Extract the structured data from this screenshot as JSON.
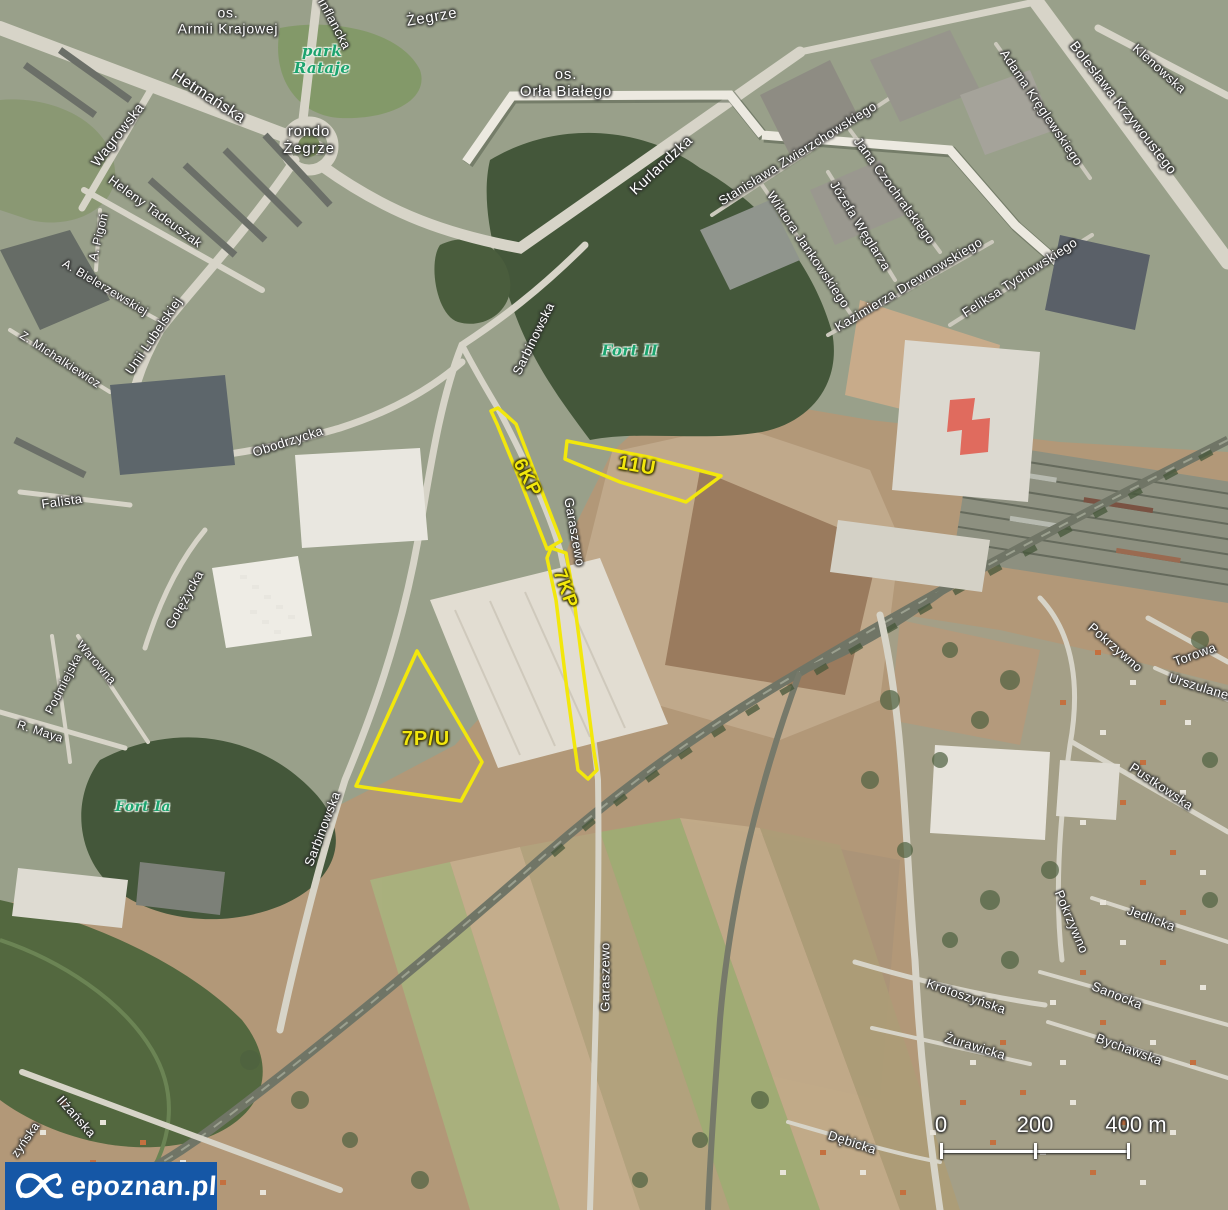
{
  "map": {
    "colors": {
      "zone_outline": "#f2e70c",
      "label_green": "#1ca36e",
      "watermark_bg": "#1557a6"
    },
    "labels": [
      {
        "t": "os.\nArmii Krajowej",
        "x": 228,
        "y": 21,
        "r": 0,
        "s": 14,
        "c": "district"
      },
      {
        "t": "Żegrze",
        "x": 432,
        "y": 18,
        "r": -10,
        "s": 15,
        "c": "district"
      },
      {
        "t": "os.\nOrła Białego",
        "x": 566,
        "y": 84,
        "r": 0,
        "s": 15,
        "c": "district"
      },
      {
        "t": "rondo\nŻegrze",
        "x": 309,
        "y": 141,
        "r": 0,
        "s": 15,
        "c": "district"
      },
      {
        "t": "park\nRataje",
        "x": 322,
        "y": 60,
        "r": 0,
        "s": 15,
        "c": "green"
      },
      {
        "t": "Fort II",
        "x": 630,
        "y": 351,
        "r": 0,
        "s": 15,
        "c": "green"
      },
      {
        "t": "Fort Ia",
        "x": 143,
        "y": 808,
        "r": 0,
        "s": 14,
        "c": "green"
      },
      {
        "t": "Hetmańska",
        "x": 208,
        "y": 97,
        "r": 33,
        "s": 16
      },
      {
        "t": "Wagrowska",
        "x": 118,
        "y": 135,
        "r": -52,
        "s": 14
      },
      {
        "t": "Inflancka",
        "x": 334,
        "y": 24,
        "r": 62,
        "s": 13
      },
      {
        "t": "Kurlandzka",
        "x": 662,
        "y": 166,
        "r": -43,
        "s": 15
      },
      {
        "t": "Heleny Tadeuszak",
        "x": 155,
        "y": 212,
        "r": 36,
        "s": 13
      },
      {
        "t": "A. Pigoń",
        "x": 99,
        "y": 237,
        "r": -76,
        "s": 12
      },
      {
        "t": "A. Bielerzewskiej",
        "x": 105,
        "y": 288,
        "r": 31,
        "s": 12
      },
      {
        "t": "Z. Michalkiewicz",
        "x": 60,
        "y": 360,
        "r": 33,
        "s": 12
      },
      {
        "t": "Unii Lubelskiej",
        "x": 154,
        "y": 336,
        "r": -56,
        "s": 13
      },
      {
        "t": "Obodrzycka",
        "x": 288,
        "y": 442,
        "r": -18,
        "s": 13
      },
      {
        "t": "Falista",
        "x": 62,
        "y": 502,
        "r": -8,
        "s": 13
      },
      {
        "t": "Gołężycka",
        "x": 185,
        "y": 600,
        "r": -61,
        "s": 13
      },
      {
        "t": "Warowna",
        "x": 96,
        "y": 663,
        "r": 49,
        "s": 12
      },
      {
        "t": "Podmiejska",
        "x": 64,
        "y": 684,
        "r": -63,
        "s": 12
      },
      {
        "t": "R. Maya",
        "x": 40,
        "y": 732,
        "r": 18,
        "s": 12
      },
      {
        "t": "Sarbinowska",
        "x": 534,
        "y": 339,
        "r": -64,
        "s": 13
      },
      {
        "t": "Sarbinowska",
        "x": 323,
        "y": 829,
        "r": -69,
        "s": 13
      },
      {
        "t": "Garaszewo",
        "x": 574,
        "y": 532,
        "r": 80,
        "s": 13
      },
      {
        "t": "Garaszewo",
        "x": 606,
        "y": 977,
        "r": -90,
        "s": 13
      },
      {
        "t": "Stanisława Zwierzchowskiego",
        "x": 798,
        "y": 154,
        "r": -32,
        "s": 13
      },
      {
        "t": "Wiktora Jankowskiego",
        "x": 808,
        "y": 250,
        "r": 56,
        "s": 13
      },
      {
        "t": "Józefa Węglarza",
        "x": 860,
        "y": 226,
        "r": 58,
        "s": 13
      },
      {
        "t": "Jana Czochralskiego",
        "x": 894,
        "y": 191,
        "r": 54,
        "s": 13
      },
      {
        "t": "Kazimierza Drewnowskiego",
        "x": 909,
        "y": 285,
        "r": -31,
        "s": 13
      },
      {
        "t": "Feliksa Tychowskiego",
        "x": 1020,
        "y": 278,
        "r": -33,
        "s": 13
      },
      {
        "t": "Adama Kręglewskiego",
        "x": 1041,
        "y": 108,
        "r": 56,
        "s": 13
      },
      {
        "t": "Bolesława Krzywoustego",
        "x": 1123,
        "y": 108,
        "r": 52,
        "s": 14
      },
      {
        "t": "Klenowska",
        "x": 1159,
        "y": 69,
        "r": 42,
        "s": 13
      },
      {
        "t": "Pokrzywno",
        "x": 1115,
        "y": 648,
        "r": 41,
        "s": 13
      },
      {
        "t": "Torowa",
        "x": 1195,
        "y": 655,
        "r": -20,
        "s": 13
      },
      {
        "t": "Urszulanek",
        "x": 1202,
        "y": 688,
        "r": 17,
        "s": 13
      },
      {
        "t": "Pustkowska",
        "x": 1161,
        "y": 787,
        "r": 34,
        "s": 13
      },
      {
        "t": "Pokrzywno",
        "x": 1071,
        "y": 922,
        "r": 67,
        "s": 13
      },
      {
        "t": "Jedlicka",
        "x": 1151,
        "y": 919,
        "r": 20,
        "s": 13
      },
      {
        "t": "Krotoszyńska",
        "x": 966,
        "y": 997,
        "r": 19,
        "s": 13
      },
      {
        "t": "Sanocka",
        "x": 1117,
        "y": 996,
        "r": 22,
        "s": 13
      },
      {
        "t": "Żurawicka",
        "x": 975,
        "y": 1047,
        "r": 17,
        "s": 13
      },
      {
        "t": "Bychawska",
        "x": 1129,
        "y": 1050,
        "r": 20,
        "s": 13
      },
      {
        "t": "Dębicka",
        "x": 852,
        "y": 1143,
        "r": 18,
        "s": 13
      },
      {
        "t": "Ilżańska",
        "x": 76,
        "y": 1117,
        "r": 48,
        "s": 13
      },
      {
        "t": "zyńska",
        "x": 26,
        "y": 1140,
        "r": -55,
        "s": 12
      }
    ],
    "zones": [
      {
        "code": "6KP",
        "label_x": 527,
        "label_y": 478,
        "label_r": 63,
        "label_s": 19,
        "points": "498,408 516,424 549,510 561,541 547,549 520,480 497,424 491,411"
      },
      {
        "code": "7KP",
        "label_x": 565,
        "label_y": 589,
        "label_r": 70,
        "label_s": 19,
        "points": "551,548 566,553 573,592 583,668 594,752 597,770 588,779 578,770 567,690 556,600 547,558"
      },
      {
        "code": "11U",
        "label_x": 637,
        "label_y": 466,
        "label_r": 10,
        "label_s": 20,
        "points": "567,441 648,457 721,476 686,502 620,482 565,459"
      },
      {
        "code": "7P/U",
        "label_x": 426,
        "label_y": 739,
        "label_r": 0,
        "label_s": 20,
        "points": "417,651 482,762 461,801 356,786"
      }
    ],
    "scale_bar": {
      "x_start": 941,
      "x_end": 1128,
      "y": 1150,
      "ticks": [
        {
          "label": "0",
          "x": 941
        },
        {
          "label": "200",
          "x": 1035
        },
        {
          "label": "400 m",
          "x": 1136
        }
      ]
    },
    "watermark": {
      "text": "epoznan.pl"
    }
  },
  "watermark": {
    "text": "epoznan.pl"
  }
}
